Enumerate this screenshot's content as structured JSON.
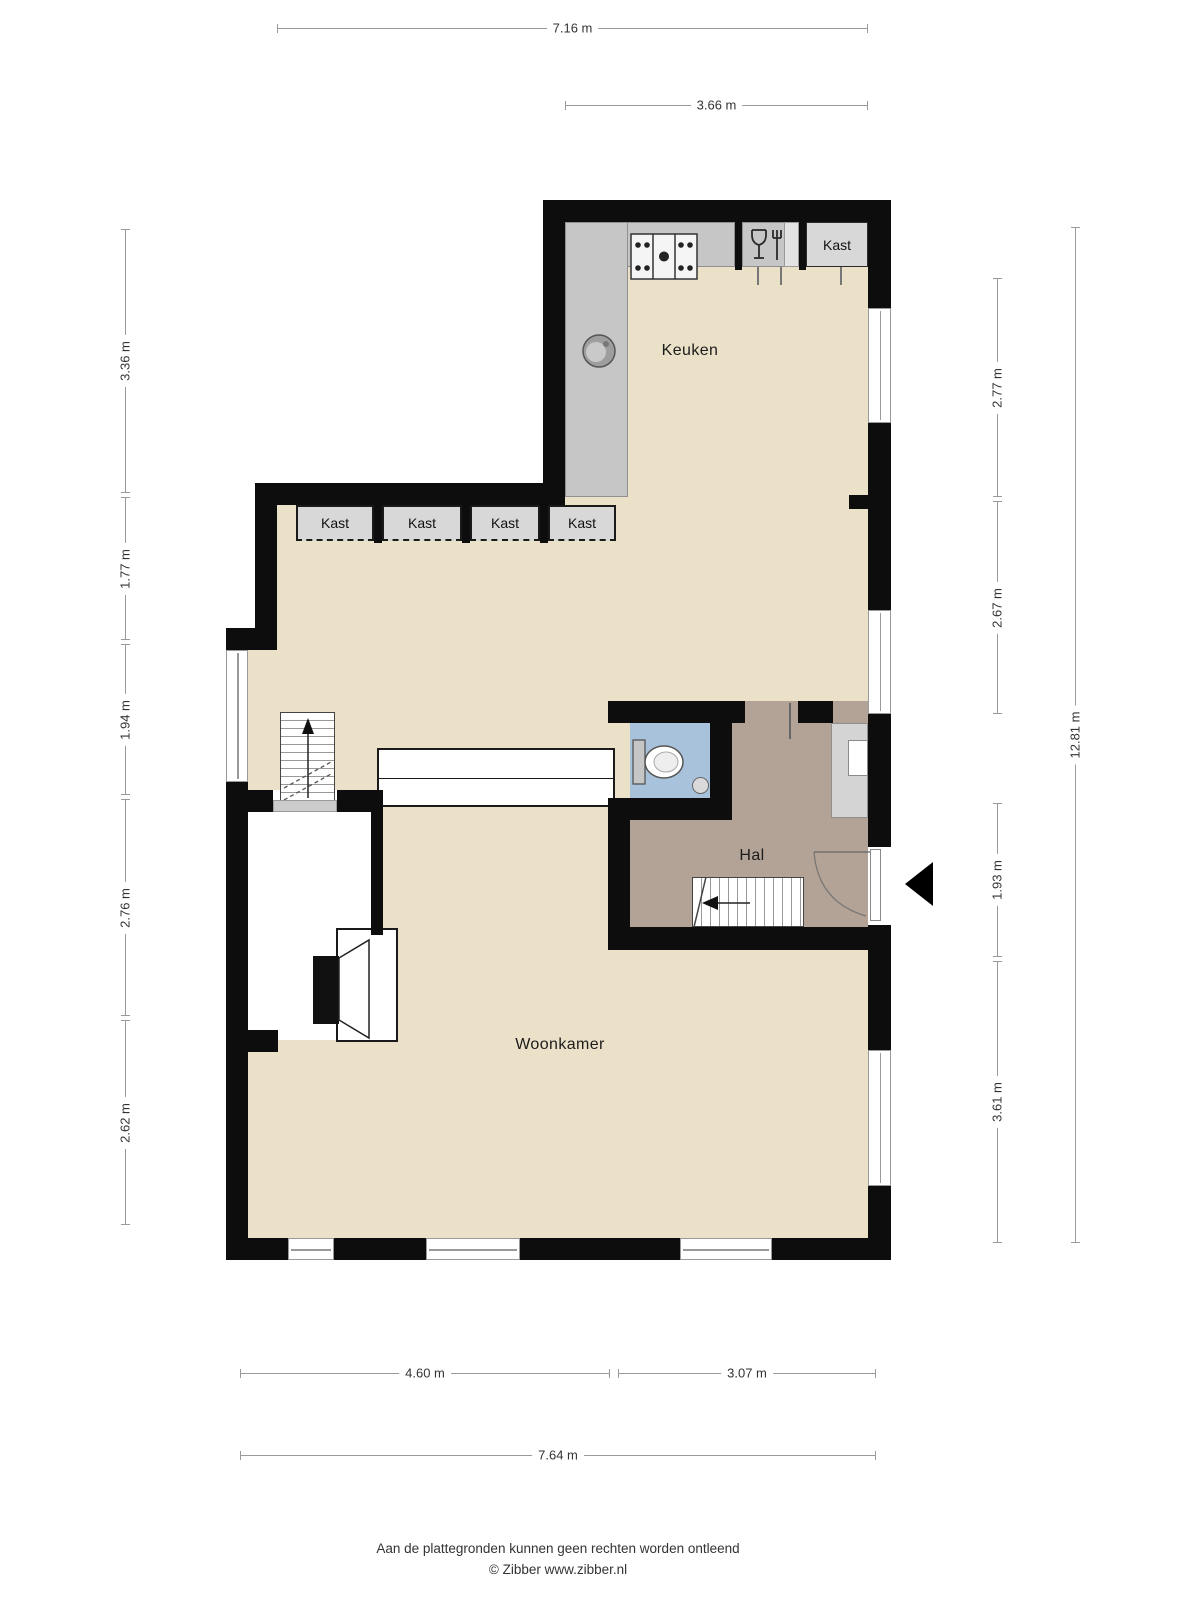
{
  "floorplan": {
    "rooms": {
      "keuken": {
        "label": "Keuken"
      },
      "hal": {
        "label": "Hal"
      },
      "woonkamer": {
        "label": "Woonkamer"
      }
    },
    "closets": {
      "row": [
        {
          "label": "Kast"
        },
        {
          "label": "Kast"
        },
        {
          "label": "Kast"
        },
        {
          "label": "Kast"
        }
      ],
      "kitchen": {
        "label": "Kast"
      }
    },
    "icons": {
      "stove": "gas-hob-icon",
      "dishwasher": "dishwasher-glass-fork-icon",
      "kitchen_sink": "round-sink-icon",
      "toilet": "toilet-icon",
      "wc_sink": "small-round-sink-icon",
      "stairs_up": "stairs-up-arrow-icon",
      "stairs_down": "stairs-down-arrow-icon",
      "entrance": "entrance-arrow-icon",
      "front_door": "door-swing-icon",
      "fireplace": "fireplace-icon"
    },
    "colors": {
      "wall": "#0d0d0d",
      "floor": "#ebe1c8",
      "wc_floor": "#a9c2dc",
      "hall_floor": "#b3a396",
      "counter": "#c6c6c6",
      "closet": "#d8d8d8",
      "dim_line": "#9a9a9a"
    }
  },
  "dimensions": {
    "top": [
      {
        "label": "7.16 m"
      },
      {
        "label": "3.66 m"
      }
    ],
    "left": [
      {
        "label": "3.36 m"
      },
      {
        "label": "1.77 m"
      },
      {
        "label": "1.94 m"
      },
      {
        "label": "2.76 m"
      },
      {
        "label": "2.62 m"
      }
    ],
    "right": [
      {
        "label": "2.77 m"
      },
      {
        "label": "2.67 m"
      },
      {
        "label": "1.93 m"
      },
      {
        "label": "3.61 m"
      }
    ],
    "right_overall": {
      "label": "12.81 m"
    },
    "bottom": [
      {
        "label": "4.60 m"
      },
      {
        "label": "3.07 m"
      }
    ],
    "bottom_overall": {
      "label": "7.64 m"
    }
  },
  "footer": {
    "disclaimer": "Aan de plattegronden kunnen geen rechten worden ontleend",
    "copyright": "© Zibber www.zibber.nl"
  }
}
